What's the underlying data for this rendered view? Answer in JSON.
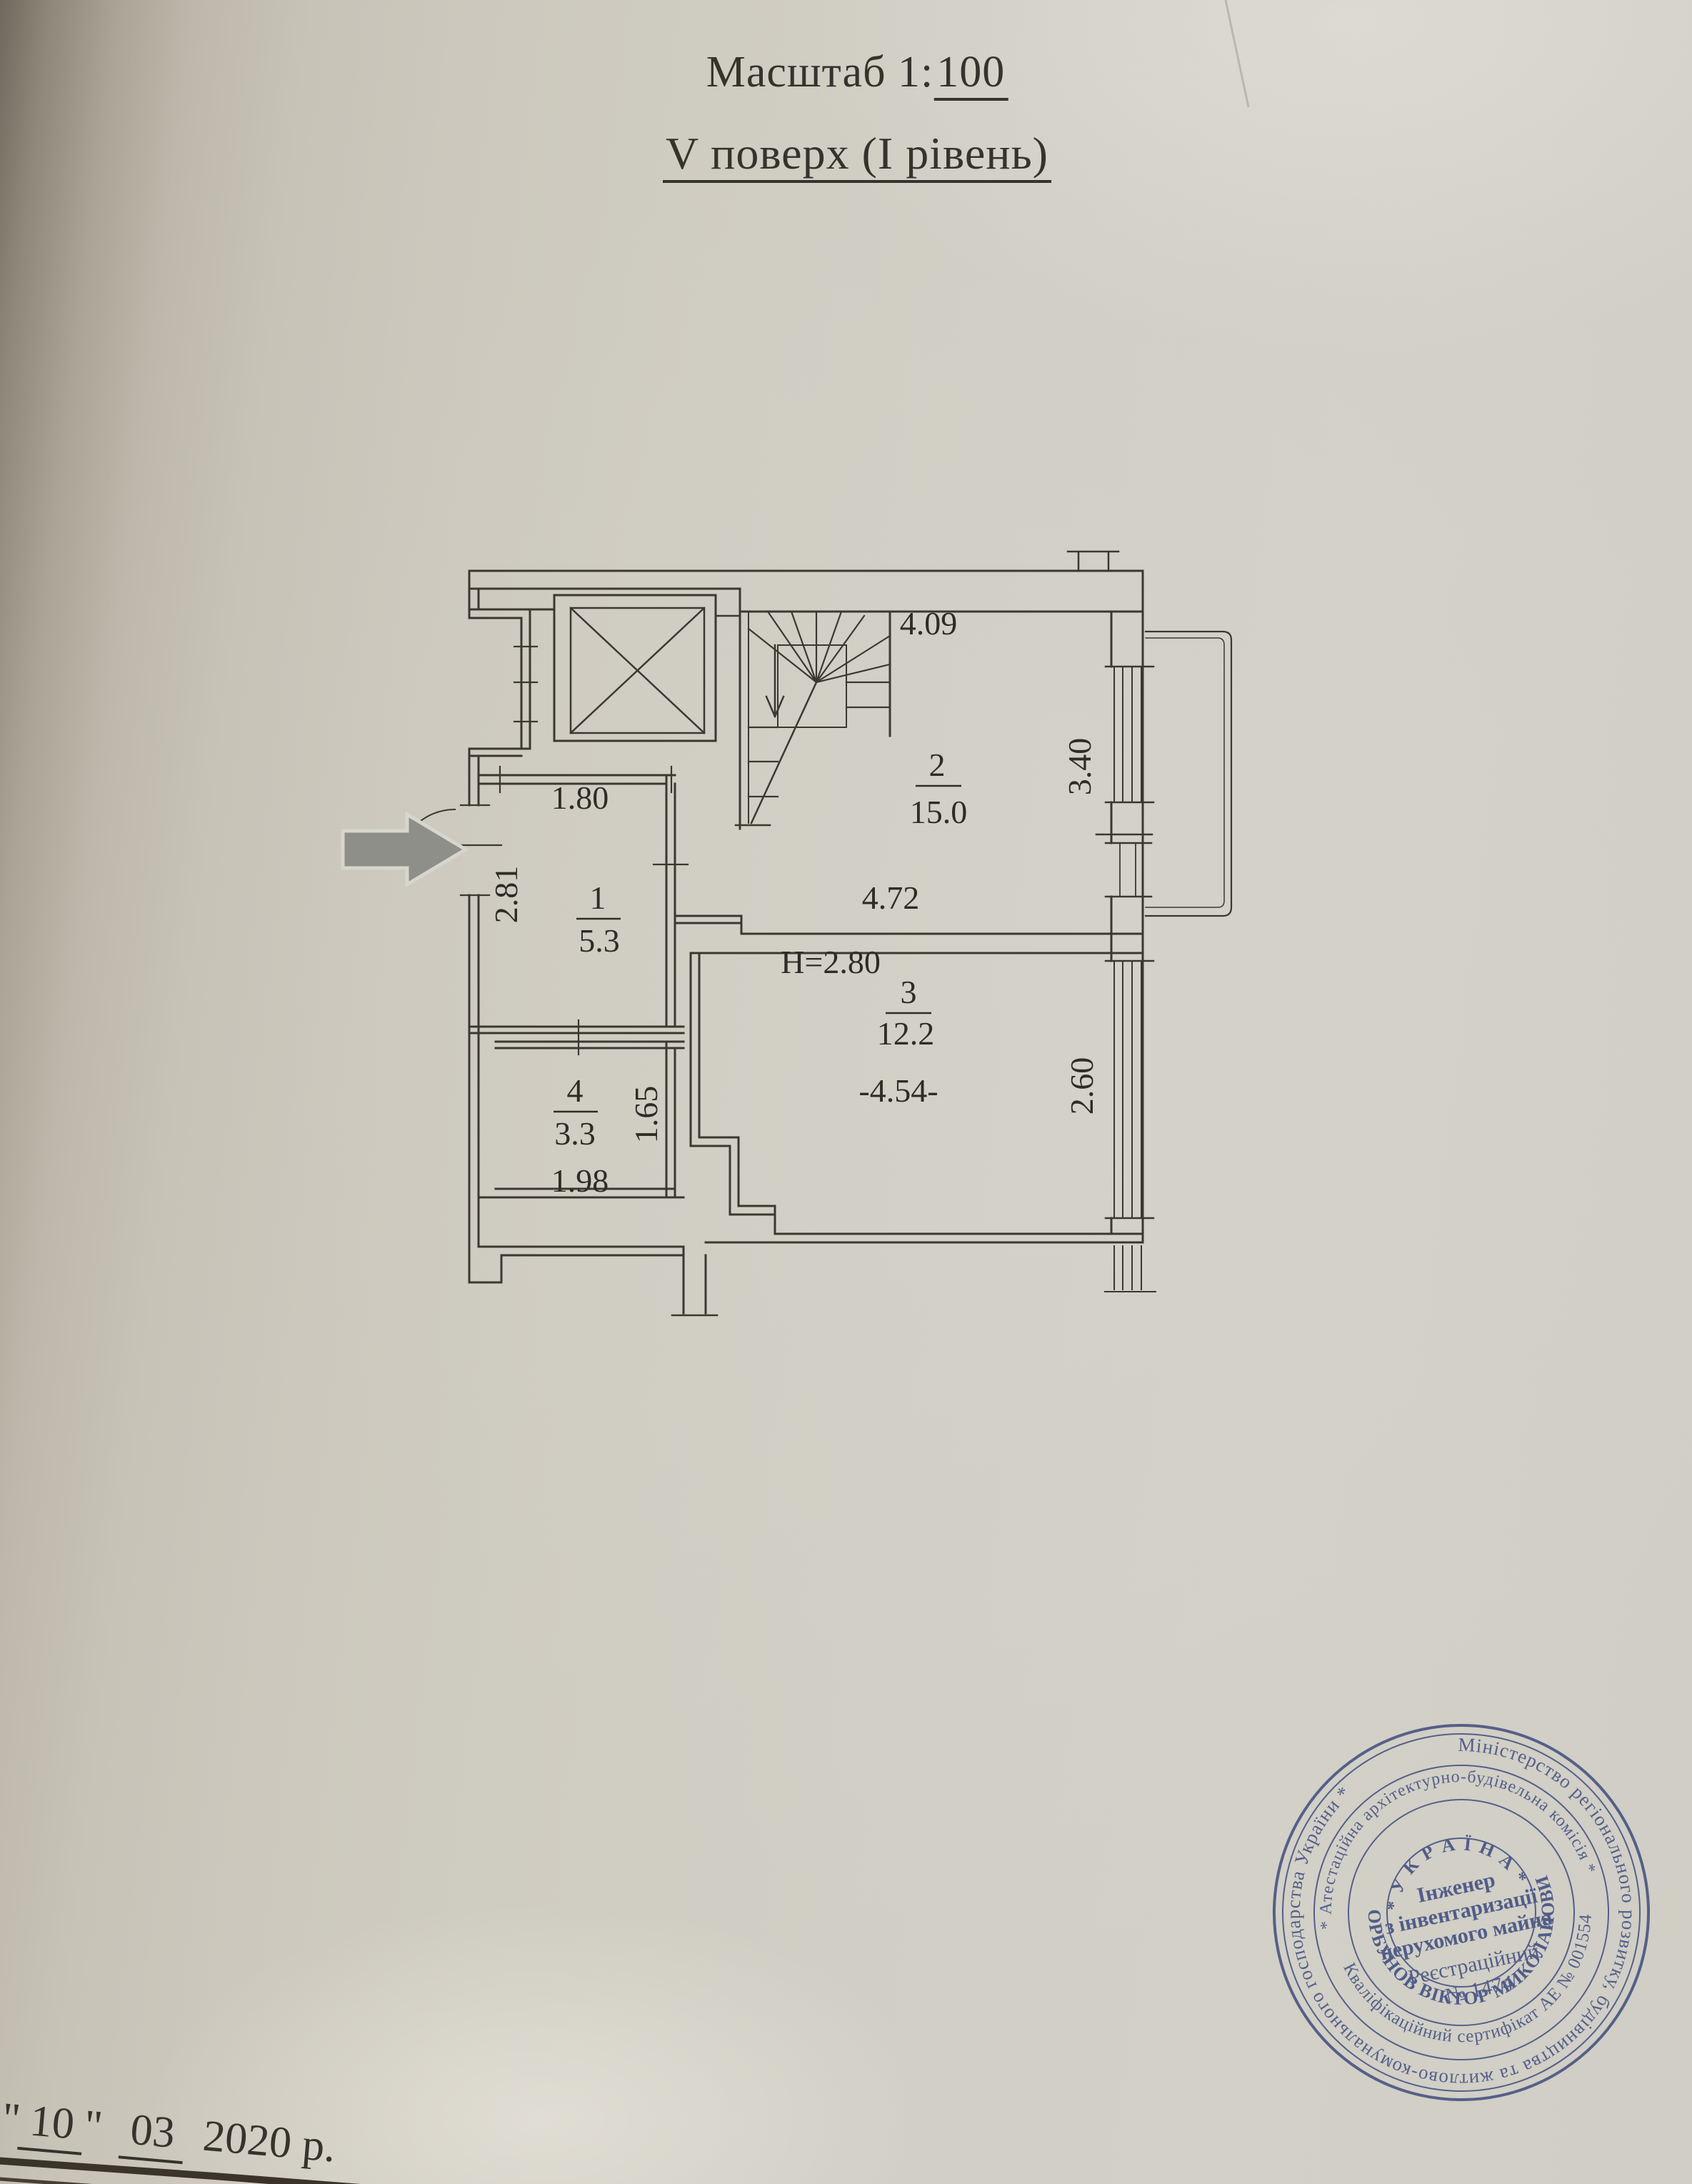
{
  "title": {
    "scale_prefix": "Масштаб 1:",
    "scale_value": "100",
    "floor": "V поверх (І рівень)"
  },
  "plan": {
    "ceiling_height": "H=2.80",
    "rooms": [
      {
        "num": "1",
        "area": "5.3"
      },
      {
        "num": "2",
        "area": "15.0"
      },
      {
        "num": "3",
        "area": "12.2"
      },
      {
        "num": "4",
        "area": "3.3"
      }
    ],
    "dims": {
      "top_width": "4.09",
      "room2_width": "4.72",
      "room2_window": "3.40",
      "room1_width": "1.80",
      "room1_depth": "2.81",
      "room3_width": "-4.54-",
      "room3_window": "2.60",
      "room4_width": "1.98",
      "room4_depth": "1.65"
    }
  },
  "stamp": {
    "ring_outer": "Міністерство регіонального розвитку, будівництва та житлово-комунального господарства України *",
    "ring_commission": "* Атестаційна архітектурно-будівельна комісія *",
    "ring_certificate": "Кваліфікаційний сертифікат АЕ № 001554",
    "name": "ГОРБУНОВ ВІКТОР МИКОЛАЙОВИЧ",
    "country": "* У К Р А Ї Н А *",
    "role_line1": "Інженер",
    "role_line2": "з інвентаризації",
    "role_line3": "нерухомого майна",
    "reg_line1": "Реєстраційний",
    "reg_line2": "№ 1474"
  },
  "date": {
    "quote_open": "\"",
    "day": "10",
    "quote_close": "\"",
    "month": "03",
    "rest": "2020 р."
  }
}
